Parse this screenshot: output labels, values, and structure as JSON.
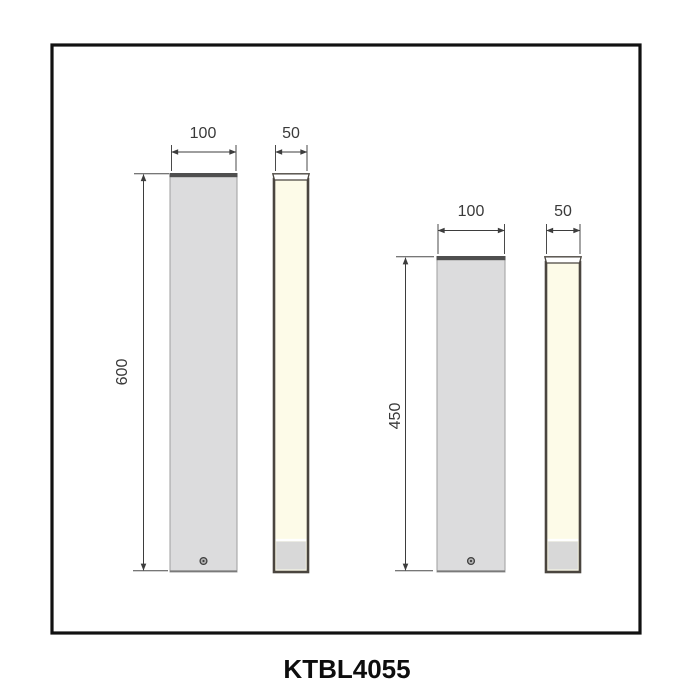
{
  "product": {
    "code": "KTBL4055"
  },
  "drawing": {
    "type": "dimensioned technical drawing of two bollard lights, front and side views",
    "models": [
      {
        "id": "bollard-600",
        "front_width": "100",
        "side_width": "50",
        "height": "600"
      },
      {
        "id": "bollard-450",
        "front_width": "100",
        "side_width": "50",
        "height": "450"
      }
    ]
  },
  "colors": {
    "frame_border": "#111111",
    "front_face": "#dcdcdd",
    "front_top_cap": "#4f4f4f",
    "lens": "#fdfbe8",
    "side_border": "#4a453f",
    "base_gray": "#d8d8d8",
    "dimension_ink": "#3d3d3d"
  }
}
